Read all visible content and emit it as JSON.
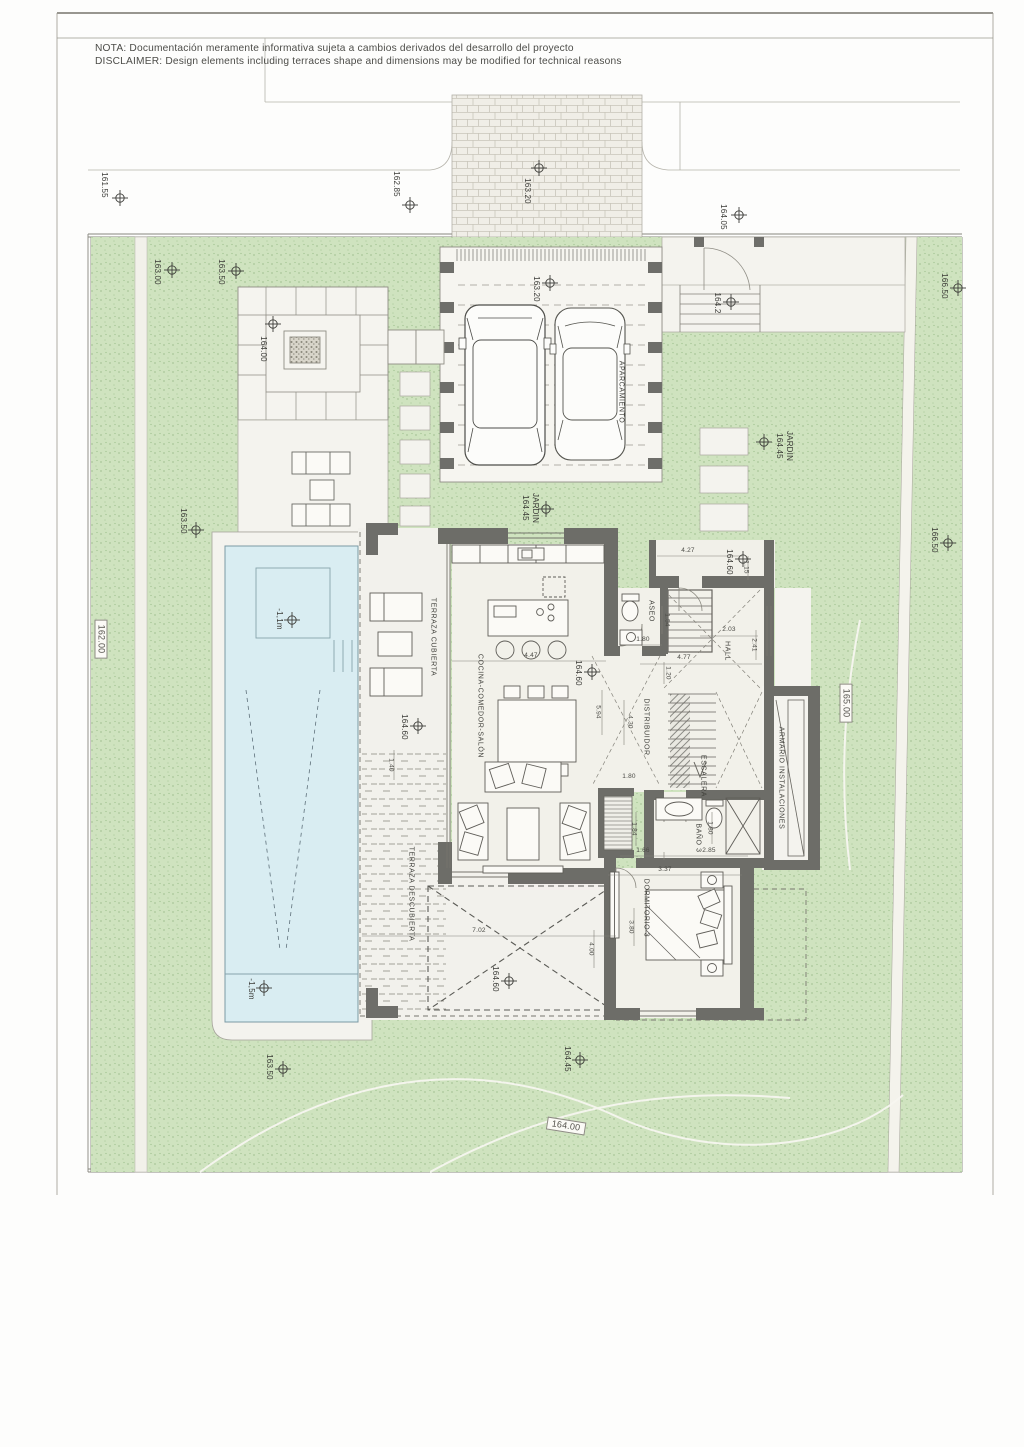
{
  "note": {
    "line1": "NOTA: Documentación meramente informativa sujeta a cambios derivados del desarrollo del proyecto",
    "line2": "DISCLAIMER: Design elements including terraces shape and dimensions may be modified for technical reasons"
  },
  "levels": {
    "street_1": "161.55",
    "street_2": "162.85",
    "street_3": "163.20",
    "street_4": "164.05",
    "entry_gate": "164.2",
    "ne_corner": "166.50",
    "garden_nw_1": "163.00",
    "garden_nw_2": "163.50",
    "pergola": "164.00",
    "parking": "163.20",
    "garden_w": "163.50",
    "garden_center": "164.45",
    "garden_east": "164.45",
    "garden_east_2": "166.50",
    "porch": "164.60",
    "house_floor": "164.60",
    "terrace_covered": "164.60",
    "terrace_open": "164.60",
    "pool_shallow": "-1,1m",
    "pool_deep": "-1,5m",
    "garden_s": "163.50",
    "garden_se": "164.45"
  },
  "jardin": "JARDIN",
  "contours": {
    "c162": "162.00",
    "c165": "165.00",
    "c164": "164.00"
  },
  "rooms": {
    "parking": "APARCAMIENTO",
    "covered_terrace": "TERRAZA CUBIERTA",
    "kitchen_living": "COCINA-COMEDOR-SALÓN",
    "toilet": "ASEO",
    "hall": "HALL",
    "corridor": "DISTRIBUIDOR",
    "stairs": "ESCALERA",
    "utility": "ARMARIO INSTALACIONES",
    "bath3": "BAÑO 3",
    "bedroom3": "DORMITORIO 3",
    "open_terrace": "TERRAZA DESCUBIERTA"
  },
  "dims": {
    "d447": "4.47",
    "d427": "4.27",
    "d115": "1.15",
    "d154": "1.54",
    "d180a": "1.80",
    "d203": "2.03",
    "d241": "2.41",
    "d477": "4.77",
    "d120": "1.20",
    "d594": "5.94",
    "d430": "4.30",
    "d180b": "1.80",
    "d184": "1.84",
    "d180c": "1.80",
    "d166": "1.66",
    "d285": "2.85",
    "d337": "3.37",
    "d380": "3.80",
    "d400": "4.00",
    "d702": "7.02",
    "d140": "1.40"
  }
}
